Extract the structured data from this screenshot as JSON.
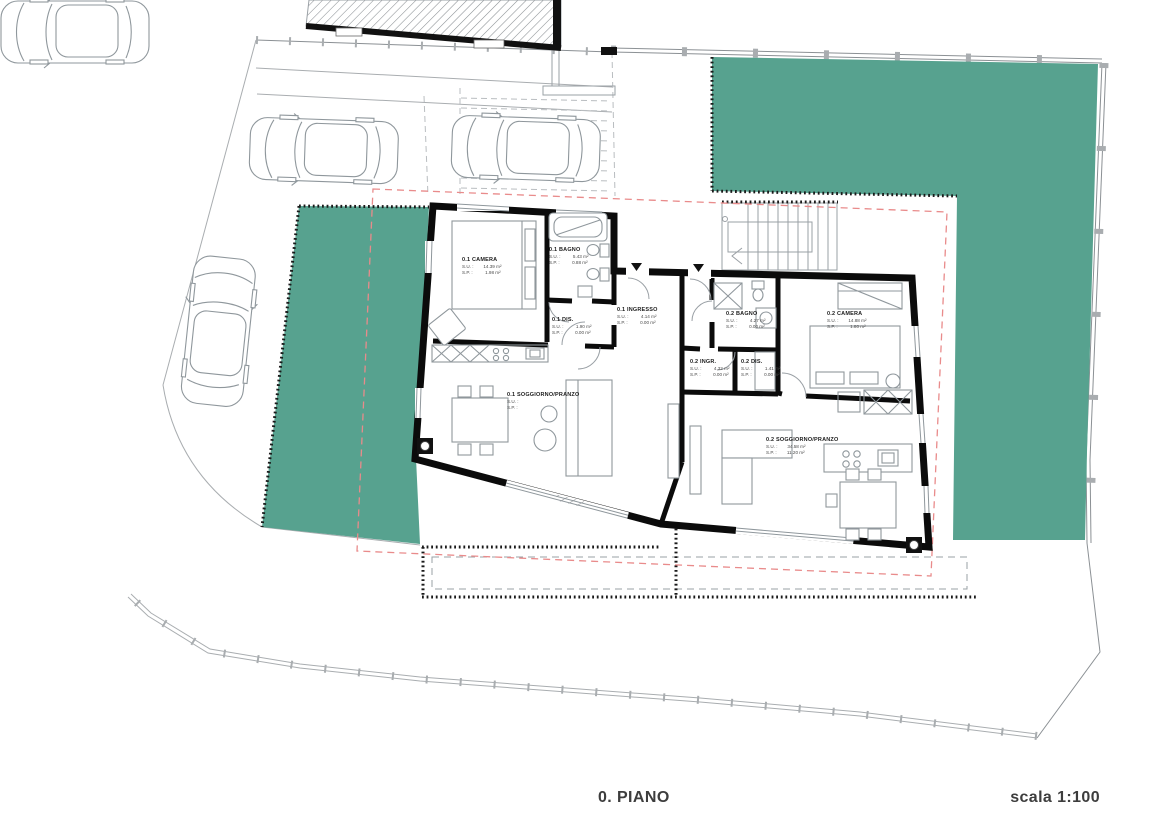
{
  "page": {
    "floor_label": "0. PIANO",
    "scale_label": "scala 1:100"
  },
  "colors": {
    "green_area": "#57a28f",
    "envelope": "#e98b8b",
    "wall": "#0b0b0b"
  },
  "labels": {
    "su": "S.U. :",
    "sp": "S.P. :"
  },
  "rooms": [
    {
      "name": "0.1 CAMERA",
      "su": "14.39 m²",
      "sp": "1.98 m²"
    },
    {
      "name": "0.1 BAGNO",
      "su": "5.43 m²",
      "sp": "0.88 m²"
    },
    {
      "name": "0.1 DIS.",
      "su": "1.90 m²",
      "sp": "0.00 m²"
    },
    {
      "name": "0.1 INGRESSO",
      "su": "4.14 m²",
      "sp": "0.00 m²"
    },
    {
      "name": "0.1 SOGGIORNO/PRANZO",
      "su": "",
      "sp": ""
    },
    {
      "name": "0.2 BAGNO",
      "su": "4.27 m²",
      "sp": "0.00 m²"
    },
    {
      "name": "0.2 INGR.",
      "su": "4.32 m²",
      "sp": "0.00 m²"
    },
    {
      "name": "0.2 DIS.",
      "su": "1.41 m²",
      "sp": "0.00 m²"
    },
    {
      "name": "0.2 CAMERA",
      "su": "14.88 m²",
      "sp": "1.80 m²"
    },
    {
      "name": "0.2 SOGGIORNO/PRANZO",
      "su": "34.58 m²",
      "sp": "11.20 m²"
    }
  ]
}
